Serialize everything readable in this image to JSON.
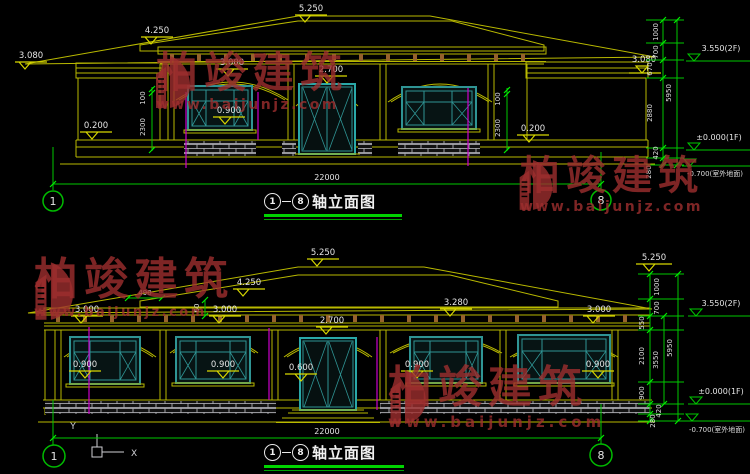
{
  "watermark": {
    "brand": "柏竣建筑",
    "url": "www.baijunjz.com"
  },
  "top_view": {
    "title_axis_start": "1",
    "title_axis_end": "8",
    "title_text": "轴立面图",
    "axis_left": "1",
    "axis_right": "8",
    "overall_width": "22000",
    "levels": {
      "ridge": "5.250",
      "porch_roof": "4.250",
      "eave_left": "3.080",
      "eave_right": "3.080",
      "arch_window": "3.000",
      "arch_door": "2.700",
      "window_sill": "0.900",
      "plinth_left": "0.200",
      "plinth_right": "0.200"
    },
    "vdim_left_upper": "100",
    "vdim_left_lower": "2300",
    "vdim_right_upper": "100",
    "vdim_right_lower": "2300",
    "chain": {
      "s1": "1000",
      "s2": "700",
      "s3": "670",
      "s4": "2880",
      "s5": "420",
      "s6": "280",
      "total": "5950"
    },
    "markers": {
      "floor2": "3.550(2F)",
      "floor1": "±0.000(1F)",
      "ground": "-0.700(室外地面)",
      "eave": "3.080"
    }
  },
  "bottom_view": {
    "title_axis_start": "1",
    "title_axis_end": "8",
    "title_text": "轴立面图",
    "axis_left": "1",
    "axis_right": "8",
    "overall_width": "22000",
    "levels": {
      "ridge": "5.250",
      "roof_mid": "4.250",
      "eave_left": "3.000",
      "arch_window2": "3.000",
      "arch_door": "2.700",
      "porch_beam": "3.280",
      "eave_right": "3.000",
      "sill_1": "0.900",
      "sill_2": "0.900",
      "sill_3": "0.900",
      "sill_4": "0.900",
      "door_step": "0.600",
      "eave_overhang_w": "490",
      "eave_overhang_h": "60"
    },
    "chain": {
      "top_level": "5.250",
      "s1": "1000",
      "s2": "700",
      "s3": "550",
      "s4": "2100",
      "s5": "900",
      "s6": "420",
      "s7": "280",
      "mid_total": "3550",
      "total": "5950"
    },
    "markers": {
      "floor2": "3.550(2F)",
      "floor1": "±0.000(1F)",
      "ground": "-0.700(室外地面)"
    },
    "ucs": {
      "x": "X",
      "y": "Y"
    }
  }
}
